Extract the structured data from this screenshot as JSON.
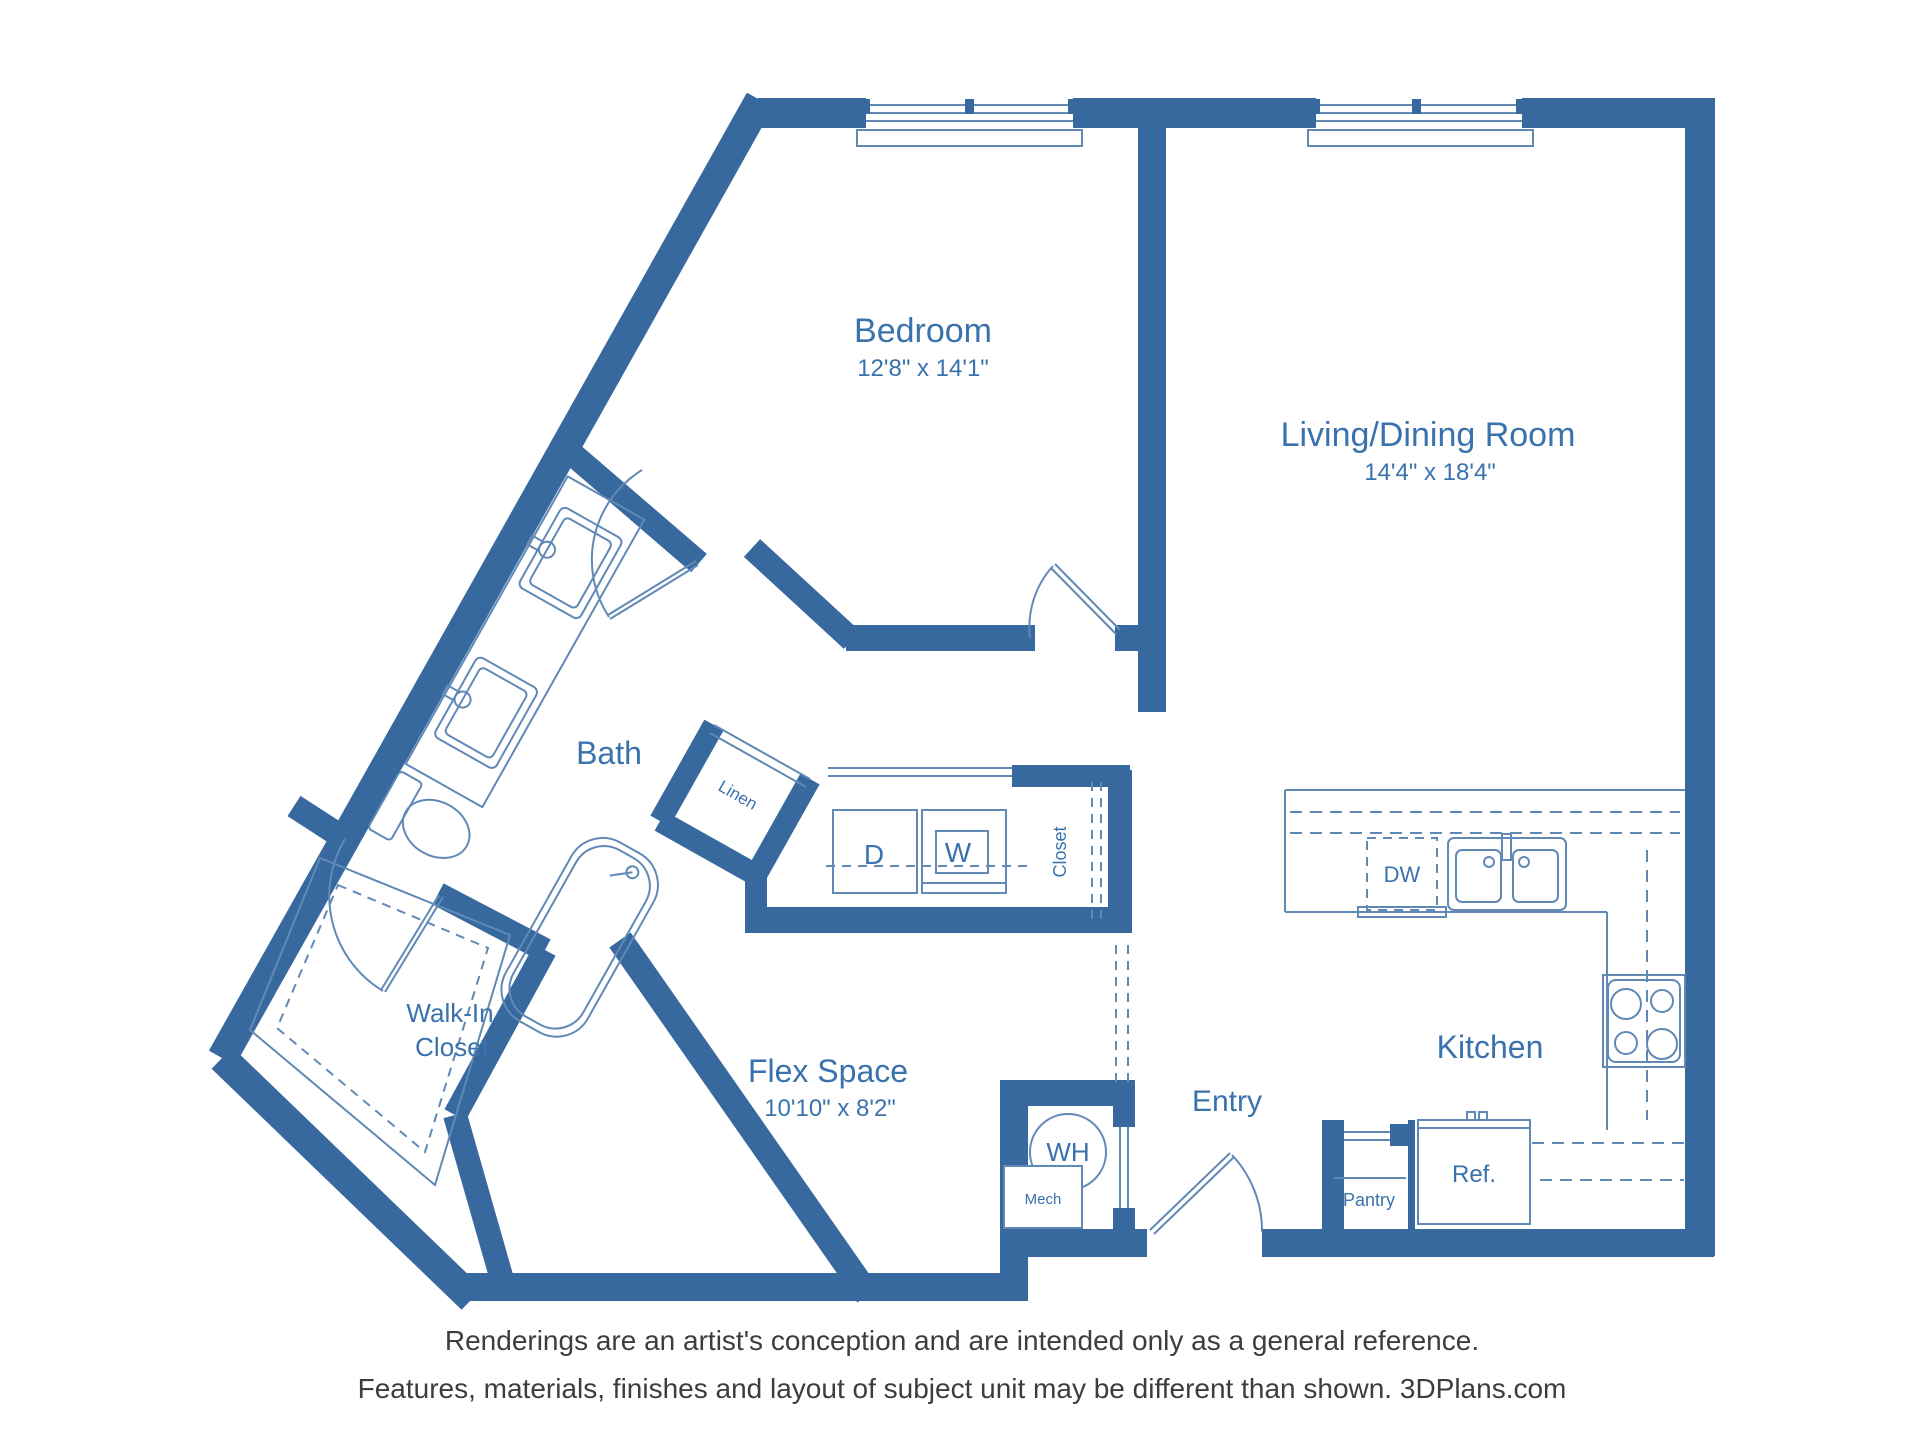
{
  "colors": {
    "wall_blue": "#38699e",
    "line_blue": "#6089b6",
    "label_blue": "#3a72ad",
    "disclaimer_gray": "#3d3d3d"
  },
  "rooms": {
    "bedroom": {
      "name": "Bedroom",
      "dims": "12'8\" x 14'1\""
    },
    "living": {
      "name": "Living/Dining Room",
      "dims": "14'4\" x 18'4\""
    },
    "bath": {
      "name": "Bath"
    },
    "wic": {
      "line1": "Walk-In",
      "line2": "Closet"
    },
    "flex": {
      "name": "Flex Space",
      "dims": "10'10\" x 8'2\""
    },
    "entry": {
      "name": "Entry"
    },
    "kitchen": {
      "name": "Kitchen"
    }
  },
  "fixtures": {
    "dryer": "D",
    "washer": "W",
    "hall_closet": "Closet",
    "linen": "Linen",
    "dishwasher": "DW",
    "water_heater": "WH",
    "mech": "Mech",
    "pantry": "Pantry",
    "refrigerator": "Ref."
  },
  "disclaimer": {
    "line1": "Renderings are an artist's conception and are intended only as a general reference.",
    "line2": "Features, materials, finishes and layout of subject unit may be different than shown. 3DPlans.com"
  }
}
